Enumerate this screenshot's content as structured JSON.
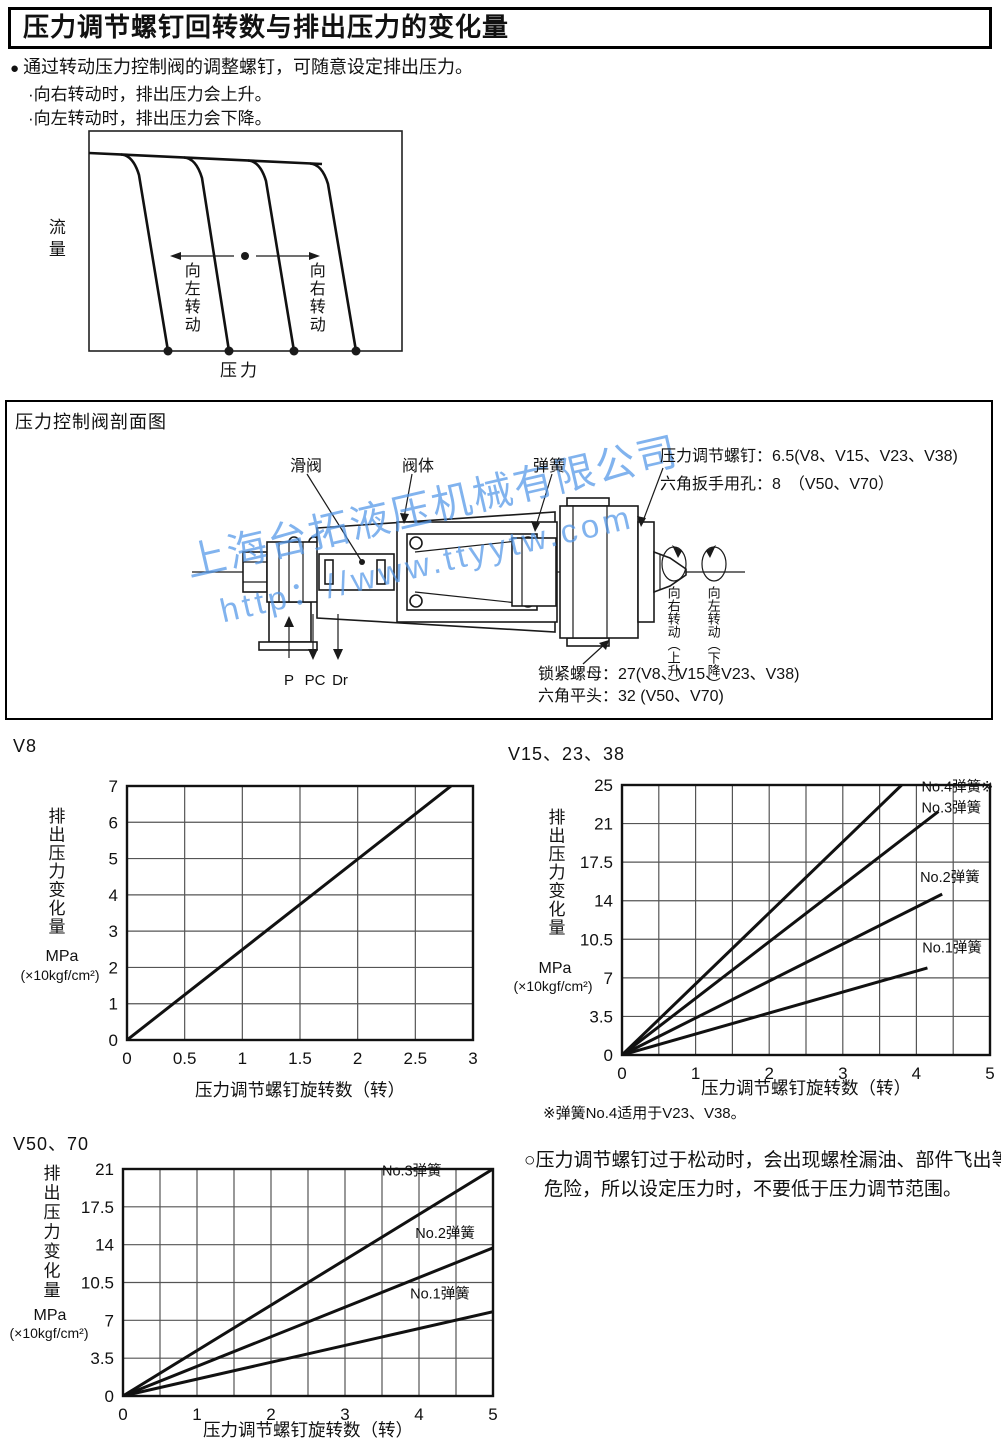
{
  "page": {
    "title": "压力调节螺钉回转数与排出压力的变化量",
    "bullet_char": "●",
    "intro": "通过转动压力控制阀的调整螺钉，可随意设定排出压力。",
    "intro_sub1": "·向右转动时，排出压力会上升。",
    "intro_sub2": "·向左转动时，排出压力会下降。"
  },
  "flow_diagram": {
    "y_axis_label": "流量",
    "x_axis_label": "压力",
    "turn_left_label": "向左转动",
    "turn_right_label": "向右转动"
  },
  "valve_section": {
    "header": "压力控制阀剖面图",
    "label_spool": "滑阀",
    "label_body": "阀体",
    "label_spring": "弹簧",
    "annotation_line1": "压力调节螺钉：6.5(V8、V15、V23、V38)",
    "annotation_line2": "六角扳手用孔：8　（V50、V70）",
    "port_p": "P",
    "port_pc": "PC",
    "port_dr": "Dr",
    "locknut_line1": "锁紧螺母：27(V8、V15、V23、V38)",
    "locknut_line2": "六角平头：32 (V50、V70)",
    "rotate_right": "向右转动（上升）",
    "rotate_left": "向左转动（下降）",
    "watermark_line1": "上海台拓液压机械有限公司",
    "watermark_line2": "http：//www.ttyytw.com"
  },
  "chart_data": [
    {
      "id": "v8",
      "type": "line",
      "title": "V8",
      "xlabel": "压力调节螺钉旋转数（转）",
      "ylabel_chars": "排出压力变化量",
      "unit_line1": "MPa",
      "unit_line2": "(×10kgf/cm²)",
      "xlim": [
        0,
        3
      ],
      "x_grid_step": 0.5,
      "x_tick_step": 0.5,
      "ylim": [
        0,
        7
      ],
      "y_ticks": [
        0,
        1,
        2,
        3,
        4,
        5,
        6,
        7
      ],
      "y_tick_labels": [
        "0",
        "1",
        "2",
        "3",
        "4",
        "5",
        "6",
        "7"
      ],
      "grid": true,
      "legend_position": "none",
      "series": [
        {
          "name": "",
          "points": [
            [
              0,
              0
            ],
            [
              2.81,
              7
            ]
          ]
        }
      ]
    },
    {
      "id": "v15",
      "type": "line",
      "title": "V15、23、38",
      "xlabel": "压力调节螺钉旋转数（转）",
      "ylabel_chars": "排出压力变化量",
      "unit_line1": "MPa",
      "unit_line2": "(×10kgf/cm²)",
      "xlim": [
        0,
        5
      ],
      "x_grid_step": 0.5,
      "x_tick_step": 1,
      "ylim": [
        0,
        24.5
      ],
      "y_ticks": [
        0,
        3.5,
        7,
        10.5,
        14,
        17.5,
        21,
        24.5
      ],
      "y_tick_labels": [
        "0",
        "3.5",
        "7",
        "10.5",
        "14",
        "17.5",
        "21",
        "25"
      ],
      "grid": true,
      "legend_position": "inline-right",
      "series": [
        {
          "name": "No.4弹簧※",
          "points": [
            [
              0,
              0
            ],
            [
              3.8,
              24.5
            ]
          ],
          "label_at": [
            4.07,
            23.9
          ]
        },
        {
          "name": "No.3弹簧",
          "points": [
            [
              0,
              0
            ],
            [
              4.3,
              22.1
            ]
          ],
          "label_at": [
            4.07,
            22.0
          ]
        },
        {
          "name": "No.2弹簧",
          "points": [
            [
              0,
              0
            ],
            [
              4.35,
              14.6
            ]
          ],
          "label_at": [
            4.05,
            15.7
          ]
        },
        {
          "name": "No.1弹簧",
          "points": [
            [
              0,
              0
            ],
            [
              4.15,
              7.9
            ]
          ],
          "label_at": [
            4.08,
            9.3
          ]
        }
      ]
    },
    {
      "id": "v50",
      "type": "line",
      "title": "V50、70",
      "xlabel": "压力调节螺钉旋转数（转）",
      "ylabel_chars": "排出压力变化量",
      "unit_line1": "MPa",
      "unit_line2": "(×10kgf/cm²)",
      "xlim": [
        0,
        5
      ],
      "x_grid_step": 0.5,
      "x_tick_step": 1,
      "ylim": [
        0,
        21
      ],
      "y_ticks": [
        0,
        3.5,
        7,
        10.5,
        14,
        17.5,
        21
      ],
      "y_tick_labels": [
        "0",
        "3.5",
        "7",
        "10.5",
        "14",
        "17.5",
        "21"
      ],
      "grid": true,
      "legend_position": "inline-right",
      "series": [
        {
          "name": "No.3弹簧",
          "points": [
            [
              0,
              0
            ],
            [
              5,
              21
            ]
          ],
          "label_at": [
            3.5,
            20.4
          ]
        },
        {
          "name": "No.2弹簧",
          "points": [
            [
              0,
              0
            ],
            [
              5,
              13.7
            ]
          ],
          "label_at": [
            3.95,
            14.6
          ]
        },
        {
          "name": "No.1弹簧",
          "points": [
            [
              0,
              0
            ],
            [
              5,
              7.8
            ]
          ],
          "label_at": [
            3.88,
            9.0
          ]
        }
      ]
    }
  ],
  "notes": {
    "footnote": "※弹簧No.4适用于V23、V38。",
    "caution": "○压力调节螺钉过于松动时，会出现螺栓漏油、部件飞出等危险，所以设定压力时，不要低于压力调节范围。"
  }
}
